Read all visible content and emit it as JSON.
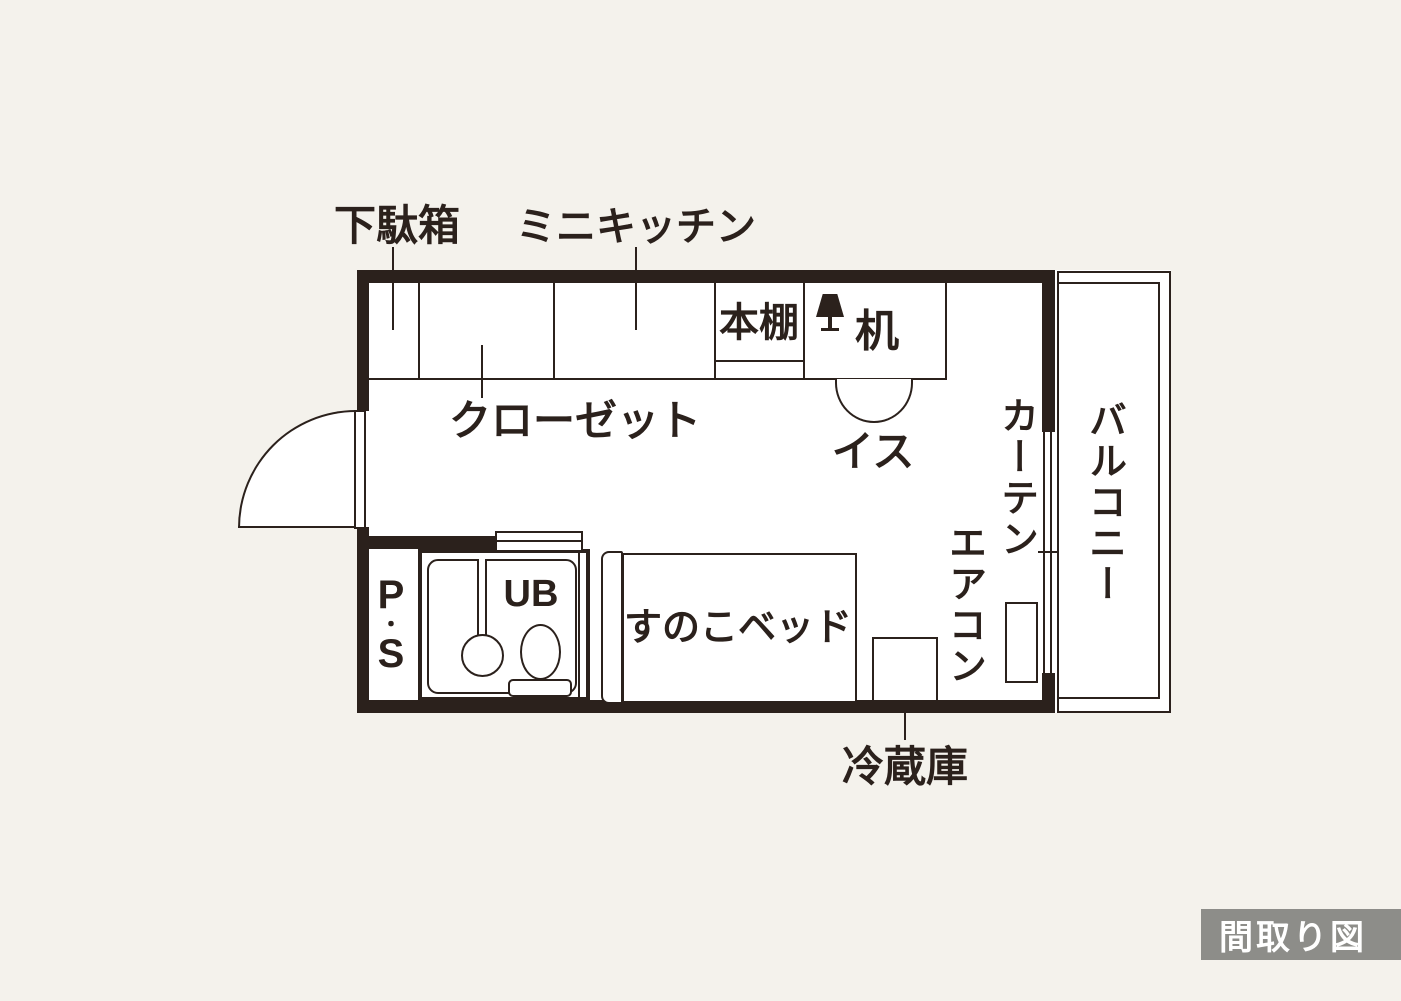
{
  "badge": {
    "label": "間取り図"
  },
  "colors": {
    "background": "#f4f2ec",
    "wall": "#2b211c",
    "floor": "#ffffff",
    "badge_bg": "#8d8d89",
    "badge_text": "#ffffff"
  },
  "plan": {
    "shoe_cabinet": {
      "label": "下駄箱"
    },
    "mini_kitchen": {
      "label": "ミニキッチン"
    },
    "closet": {
      "label": "クローゼット"
    },
    "bookshelf": {
      "label": "本棚"
    },
    "desk": {
      "label": "机"
    },
    "chair": {
      "label": "イス"
    },
    "curtain": {
      "label": "カーテン"
    },
    "air_conditioner": {
      "label": "エアコン"
    },
    "balcony": {
      "label": "バルコニー"
    },
    "pipe_space": {
      "label": "P・S",
      "chars": [
        "P",
        "・",
        "S"
      ]
    },
    "unit_bath": {
      "label": "UB"
    },
    "bed": {
      "label": "すのこベッド"
    },
    "refrigerator": {
      "label": "冷蔵庫"
    }
  }
}
